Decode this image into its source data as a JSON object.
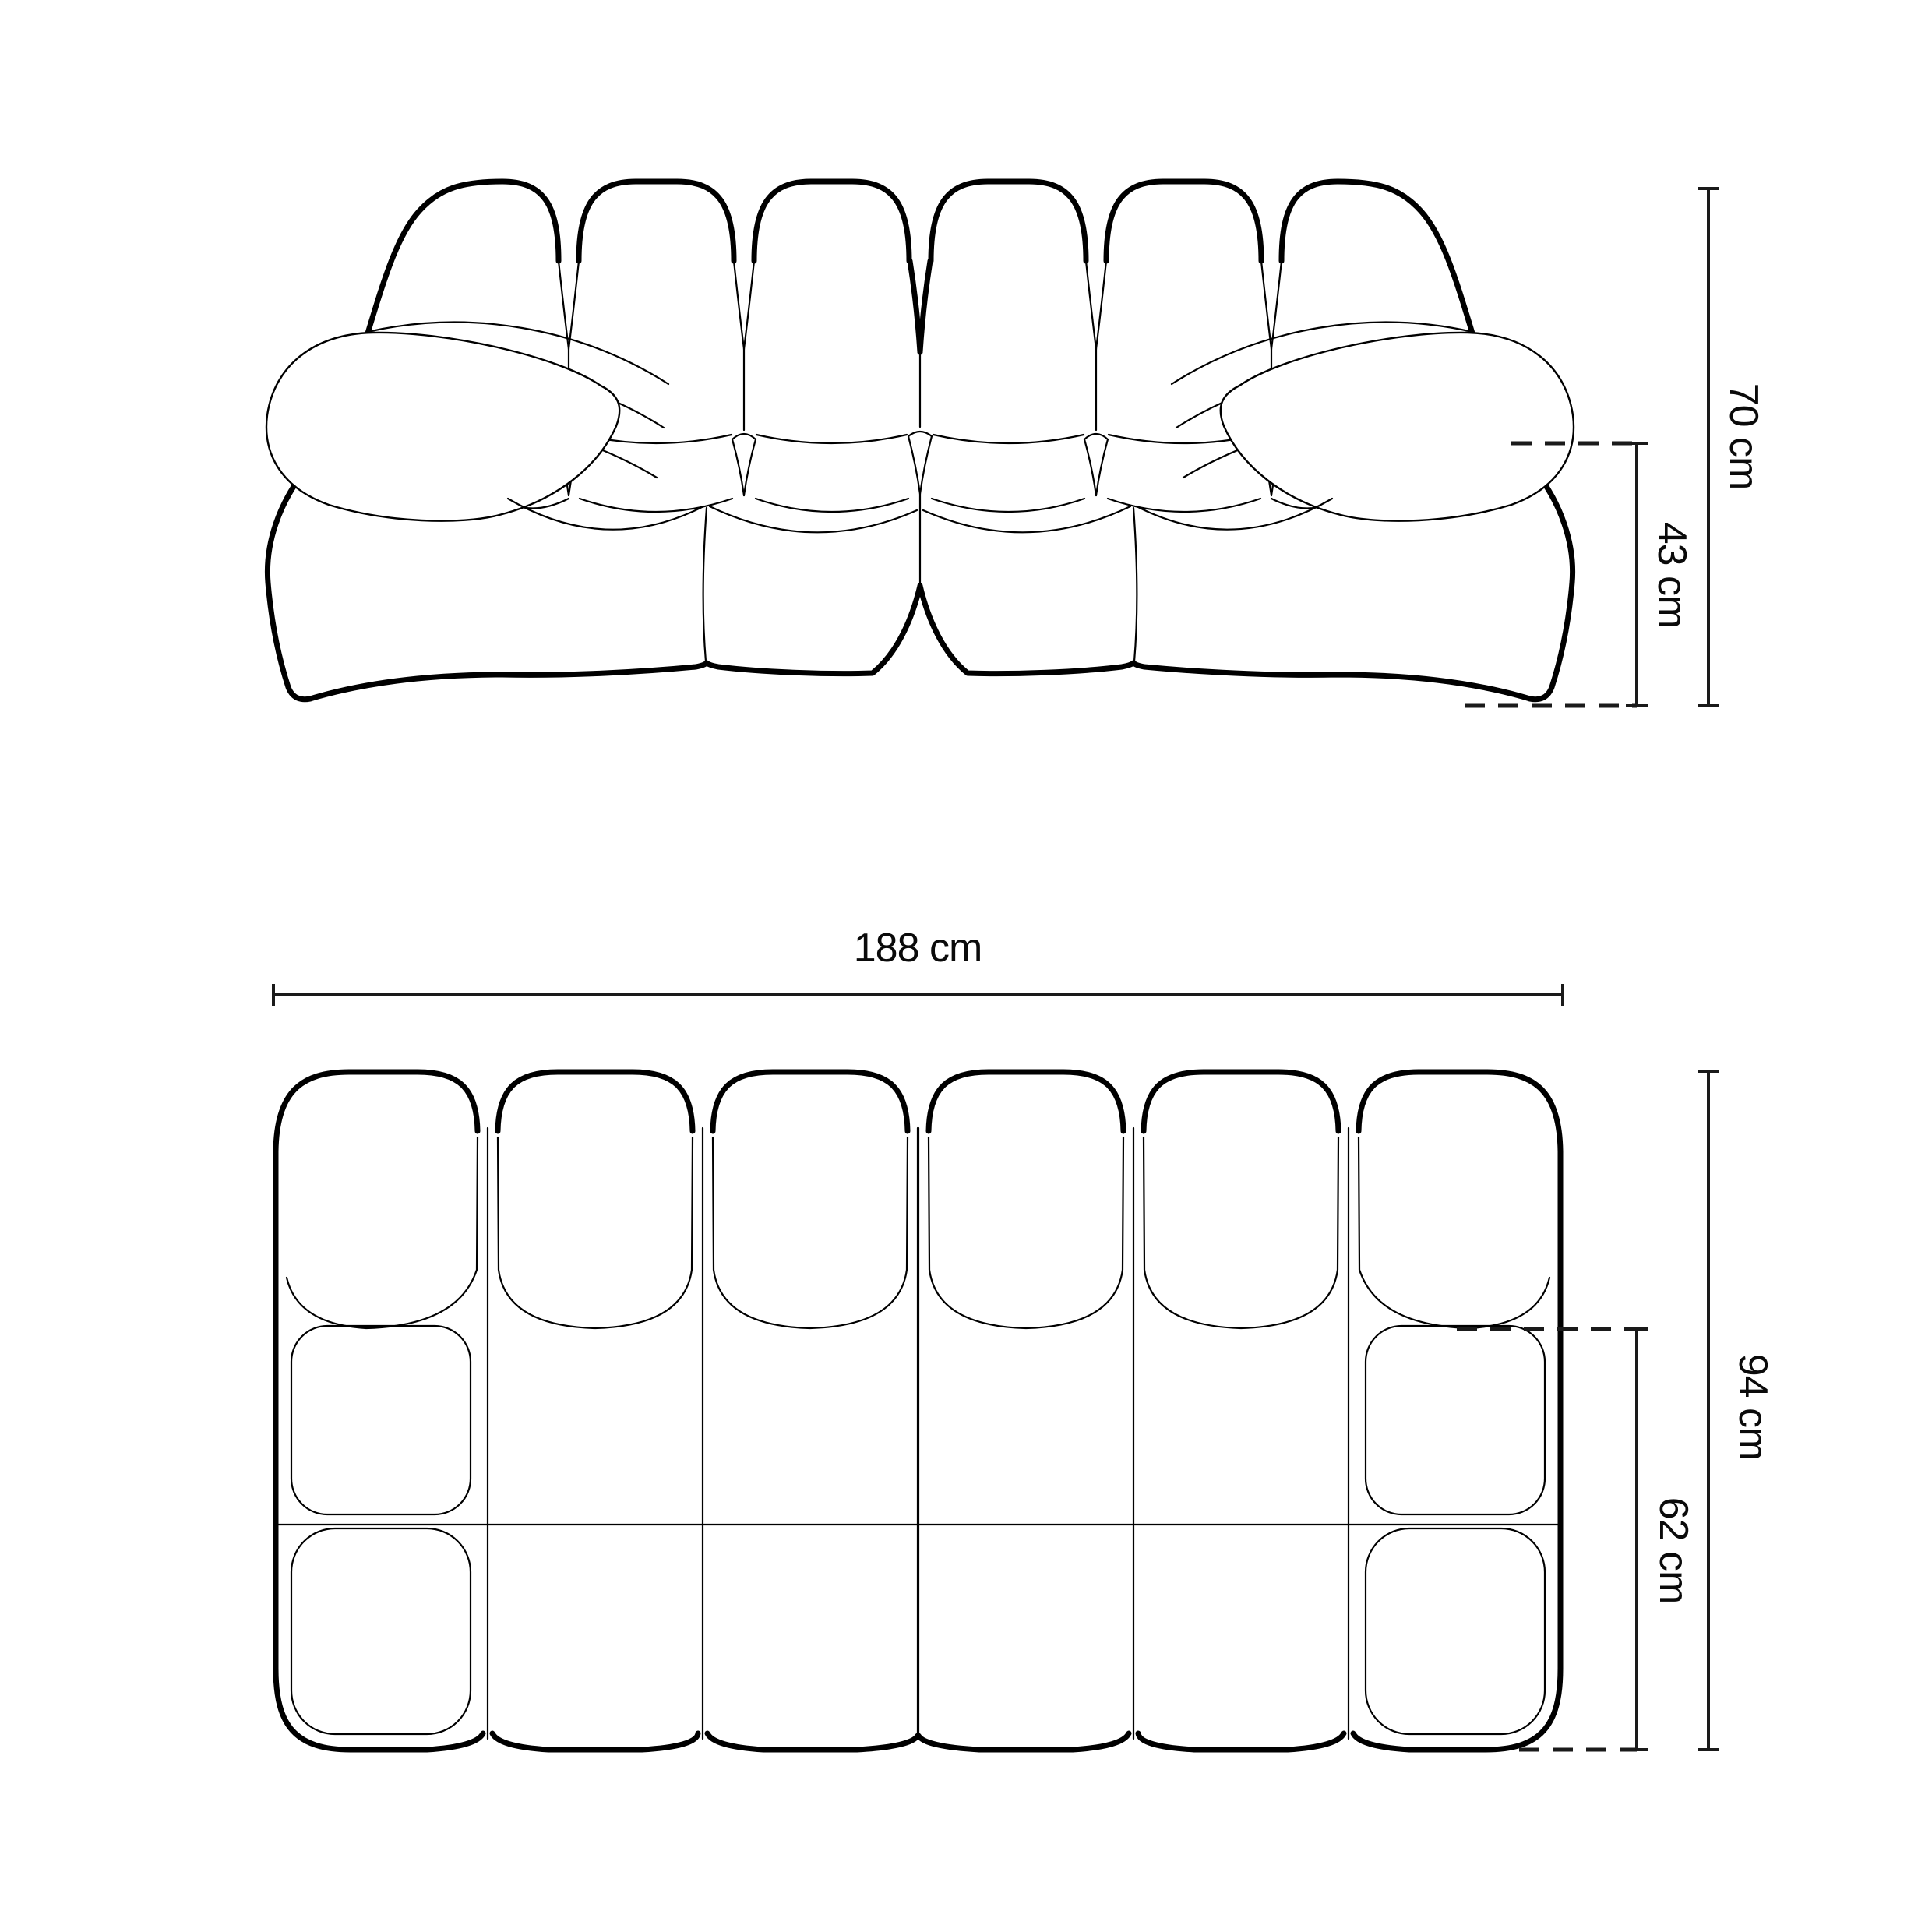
{
  "document": {
    "kind": "furniture dimension drawing",
    "background_color": "#ffffff",
    "line_color": "#000000",
    "label_color": "#0a0a0a"
  },
  "front_view": {
    "height_label": "70 cm",
    "seat_height_label": "43 cm"
  },
  "top_view": {
    "width_label": "188 cm",
    "depth_label": "94 cm",
    "seat_depth_label": "62 cm"
  }
}
